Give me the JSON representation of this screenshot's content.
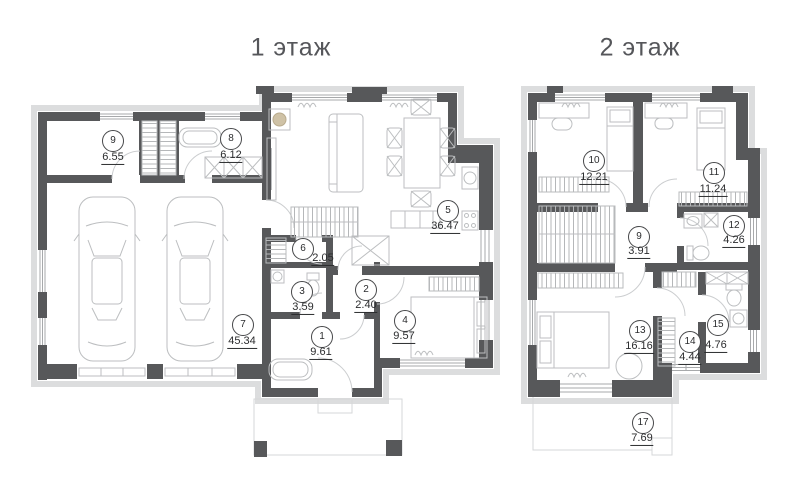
{
  "page": {
    "background": "#ffffff"
  },
  "colors": {
    "wall": "#57585a",
    "exterior_band": "#dcddde",
    "furniture_line": "#bcbec0",
    "window_line": "#a7a9ab",
    "door_arc": "#cbcdcf",
    "label_text": "#2b2c2e",
    "title_text": "#55565a"
  },
  "floors": [
    {
      "title": "1 этаж",
      "rooms": [
        {
          "number": "9",
          "area": "6.55"
        },
        {
          "number": "8",
          "area": "6.12"
        },
        {
          "number": "5",
          "area": "36.47"
        },
        {
          "number": "6",
          "area": "2.05"
        },
        {
          "number": "3",
          "area": "3.59"
        },
        {
          "number": "2",
          "area": "2.40"
        },
        {
          "number": "4",
          "area": "9.57"
        },
        {
          "number": "1",
          "area": "9.61"
        },
        {
          "number": "7",
          "area": "45.34"
        }
      ]
    },
    {
      "title": "2 этаж",
      "rooms": [
        {
          "number": "10",
          "area": "12.21"
        },
        {
          "number": "11",
          "area": "11.24"
        },
        {
          "number": "9",
          "area": "3.91"
        },
        {
          "number": "12",
          "area": "4.26"
        },
        {
          "number": "13",
          "area": "16.16"
        },
        {
          "number": "14",
          "area": "4.44"
        },
        {
          "number": "15",
          "area": "4.76"
        },
        {
          "number": "17",
          "area": "7.69"
        }
      ]
    }
  ]
}
